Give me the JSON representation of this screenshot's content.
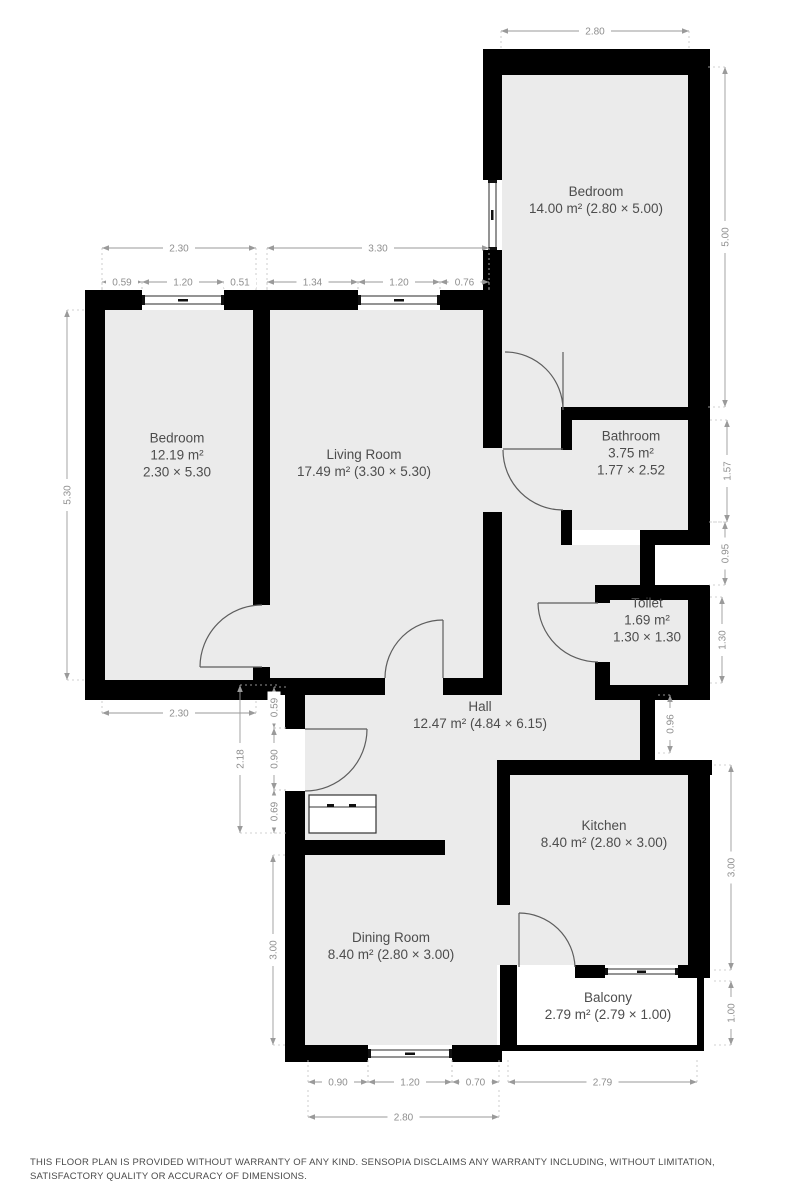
{
  "document": {
    "type": "floor-plan",
    "disclaimer": "THIS FLOOR PLAN IS PROVIDED WITHOUT WARRANTY OF ANY KIND. SENSOPIA DISCLAIMS ANY WARRANTY INCLUDING, WITHOUT LIMITATION, SATISFACTORY QUALITY OR ACCURACY OF DIMENSIONS."
  },
  "colors": {
    "wall": "#000000",
    "floor": "#ebebeb",
    "room_label": "#4d4d4d",
    "dimension": "#8f8f8f",
    "background": "#ffffff"
  },
  "rooms": [
    {
      "id": "bedroom-top",
      "lines": [
        "Bedroom",
        "14.00 m² (2.80 × 5.00)"
      ],
      "cx": 596,
      "cy": 200
    },
    {
      "id": "bedroom-left",
      "lines": [
        "Bedroom",
        "12.19 m²",
        "2.30 × 5.30"
      ],
      "cx": 177,
      "cy": 455
    },
    {
      "id": "living-room",
      "lines": [
        "Living Room",
        "17.49 m² (3.30 × 5.30)"
      ],
      "cx": 364,
      "cy": 463
    },
    {
      "id": "bathroom",
      "lines": [
        "Bathroom",
        "3.75 m²",
        "1.77 × 2.52"
      ],
      "cx": 631,
      "cy": 453
    },
    {
      "id": "toilet",
      "lines": [
        "Toilet",
        "1.69 m²",
        "1.30 × 1.30"
      ],
      "cx": 647,
      "cy": 620
    },
    {
      "id": "hall",
      "lines": [
        "Hall",
        "12.47 m² (4.84 × 6.15)"
      ],
      "cx": 480,
      "cy": 715
    },
    {
      "id": "kitchen",
      "lines": [
        "Kitchen",
        "8.40 m² (2.80 × 3.00)"
      ],
      "cx": 604,
      "cy": 834
    },
    {
      "id": "dining-room",
      "lines": [
        "Dining Room",
        "8.40 m² (2.80 × 3.00)"
      ],
      "cx": 391,
      "cy": 946
    },
    {
      "id": "balcony",
      "lines": [
        "Balcony",
        "2.79 m² (2.79 × 1.00)"
      ],
      "cx": 608,
      "cy": 1006
    }
  ],
  "dimensions": [
    {
      "label": "2.80",
      "o": "h",
      "x1": 501,
      "x2": 689,
      "y": 31,
      "ext": 20
    },
    {
      "label": "2.30",
      "o": "h",
      "x1": 102,
      "x2": 256,
      "y": 248,
      "ext": 44
    },
    {
      "label": "3.30",
      "o": "h",
      "x1": 267,
      "x2": 489,
      "y": 248,
      "ext": 44
    },
    {
      "label": "0.59",
      "o": "h",
      "x1": 102,
      "x2": 142,
      "y": 282,
      "ext": 10
    },
    {
      "label": "1.20",
      "o": "h",
      "x1": 142,
      "x2": 224,
      "y": 282,
      "ext": 10
    },
    {
      "label": "0.51",
      "o": "h",
      "x1": 224,
      "x2": 256,
      "y": 282,
      "ext": 10
    },
    {
      "label": "1.34",
      "o": "h",
      "x1": 267,
      "x2": 358,
      "y": 282,
      "ext": 10
    },
    {
      "label": "1.20",
      "o": "h",
      "x1": 358,
      "x2": 440,
      "y": 282,
      "ext": 10
    },
    {
      "label": "0.76",
      "o": "h",
      "x1": 440,
      "x2": 489,
      "y": 282,
      "ext": 10
    },
    {
      "label": "5.00",
      "o": "v",
      "y1": 67,
      "y2": 407,
      "x": 725,
      "ext": -18
    },
    {
      "label": "1.57",
      "o": "v",
      "y1": 420,
      "y2": 522,
      "x": 727,
      "ext": -18
    },
    {
      "label": "0.95",
      "o": "v",
      "y1": 522,
      "y2": 585,
      "x": 725,
      "ext": -16
    },
    {
      "label": "1.30",
      "o": "v",
      "y1": 597,
      "y2": 683,
      "x": 722,
      "ext": -14
    },
    {
      "label": "0.96",
      "o": "v",
      "y1": 695,
      "y2": 753,
      "x": 670,
      "ext": -12
    },
    {
      "label": "3.00",
      "o": "v",
      "y1": 765,
      "y2": 970,
      "x": 731,
      "ext": -18
    },
    {
      "label": "1.00",
      "o": "v",
      "y1": 981,
      "y2": 1045,
      "x": 731,
      "ext": -18
    },
    {
      "label": "5.30",
      "o": "v",
      "y1": 310,
      "y2": 680,
      "x": 67,
      "ext": 18
    },
    {
      "label": "2.30",
      "o": "h",
      "x1": 102,
      "x2": 256,
      "y": 713,
      "ext": -12
    },
    {
      "label": "2.18",
      "o": "v",
      "y1": 685,
      "y2": 833,
      "x": 240,
      "ext": 40
    },
    {
      "label": "0.59",
      "o": "v",
      "y1": 687,
      "y2": 728,
      "x": 274,
      "ext": 12
    },
    {
      "label": "0.90",
      "o": "v",
      "y1": 728,
      "y2": 790,
      "x": 274,
      "ext": 12
    },
    {
      "label": "0.69",
      "o": "v",
      "y1": 790,
      "y2": 833,
      "x": 274,
      "ext": 12
    },
    {
      "label": "3.00",
      "o": "v",
      "y1": 855,
      "y2": 1045,
      "x": 273,
      "ext": 14
    },
    {
      "label": "0.90",
      "o": "h",
      "x1": 308,
      "x2": 368,
      "y": 1082,
      "ext": -22
    },
    {
      "label": "1.20",
      "o": "h",
      "x1": 368,
      "x2": 452,
      "y": 1082,
      "ext": -22
    },
    {
      "label": "0.70",
      "o": "h",
      "x1": 452,
      "x2": 499,
      "y": 1082,
      "ext": -22
    },
    {
      "label": "2.79",
      "o": "h",
      "x1": 508,
      "x2": 697,
      "y": 1082,
      "ext": -22
    },
    {
      "label": "2.80",
      "o": "h",
      "x1": 308,
      "x2": 499,
      "y": 1117,
      "ext": -28
    }
  ]
}
